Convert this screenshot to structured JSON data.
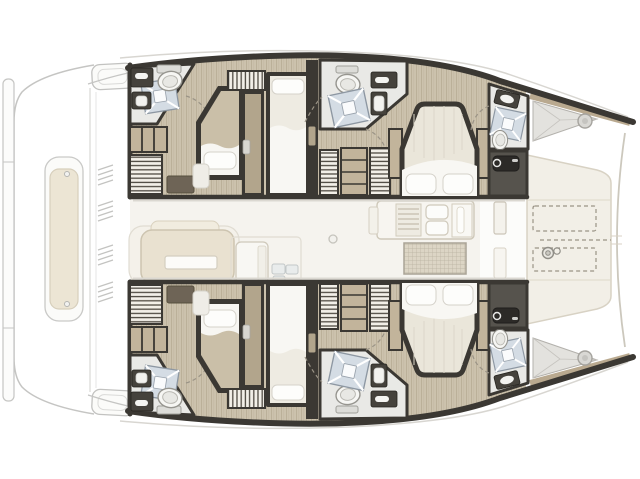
{
  "page": {
    "background": "#ffffff",
    "aria_label": "Catamaran interior layout floor plan, top-down view, bow to the right"
  },
  "colors": {
    "background": "#ffffff",
    "wall": "#3b3833",
    "floor_wood": "#ccc2ad",
    "floor_wood_grain": "#b7ab94",
    "saloon_floor": "#f5f3ee",
    "bathroom_floor": "#e9e9e6",
    "shower_tile": "#d4dce4",
    "fixture_white": "#f6f6f3",
    "fixture_outline": "#96958f",
    "vanity_dark": "#45423c",
    "tech_room": "#56534d",
    "furniture_dark": "#6e6456",
    "cabinet_tan": "#c2b49b",
    "locker_bg": "#f2efe8",
    "locker_stripe": "#4e4941",
    "bed_mattress": "#eae6da",
    "bed_blanket": "#cabfa8",
    "bed_sheet": "#f8f7f3",
    "deck_cream": "#f2efe7",
    "deck_line": "#d8d2c4",
    "outline_light": "#c5c5c3",
    "bench_beige": "#ece5d4",
    "bow_band_tan": "#b9a98f",
    "grid_mat": "#dcd5c5",
    "dash_line": "#9a9386"
  },
  "vessel": {
    "type": "catamaran",
    "view": "top-down interior floor plan",
    "bow_direction": "right",
    "hulls": [
      {
        "id": "port-hull",
        "position": "top",
        "rooms": [
          "aft double cabin with bathroom",
          "forward island double cabin with bathroom",
          "bow bathroom",
          "technical room",
          "bow locker"
        ],
        "furniture": [
          "double bed",
          "single bed",
          "island double bed",
          "hanging lockers",
          "shelved cabinet",
          "rug"
        ]
      },
      {
        "id": "starboard-hull",
        "position": "bottom",
        "rooms": [
          "aft double cabin with bathroom",
          "forward island double cabin with bathroom",
          "bow bathroom",
          "technical room",
          "bow locker"
        ],
        "furniture": [
          "double bed",
          "single bed",
          "island double bed",
          "hanging lockers",
          "shelved cabinet",
          "rug"
        ]
      }
    ],
    "saloon": {
      "features": [
        "lounge sofa",
        "coffee table",
        "galley unit",
        "refrigerator boxes",
        "stove",
        "double sink",
        "counter",
        "woven floor mat",
        "deck fitting",
        "foredeck door"
      ]
    },
    "foredeck": {
      "features": [
        "sun pad (dashed)",
        "sun pad (dashed)",
        "anchor chain line",
        "anchor windlass",
        "bow crossbeam"
      ]
    },
    "stern": {
      "features": [
        "swim platform",
        "transom steps",
        "aft bench / dinghy storage",
        "deck vents"
      ]
    }
  },
  "icons": [
    "shower-icon",
    "toilet-icon",
    "sink-icon",
    "windlass-icon",
    "hatch-icon",
    "hanger-locker-icon",
    "vent-icon",
    "door-swing-icon"
  ]
}
